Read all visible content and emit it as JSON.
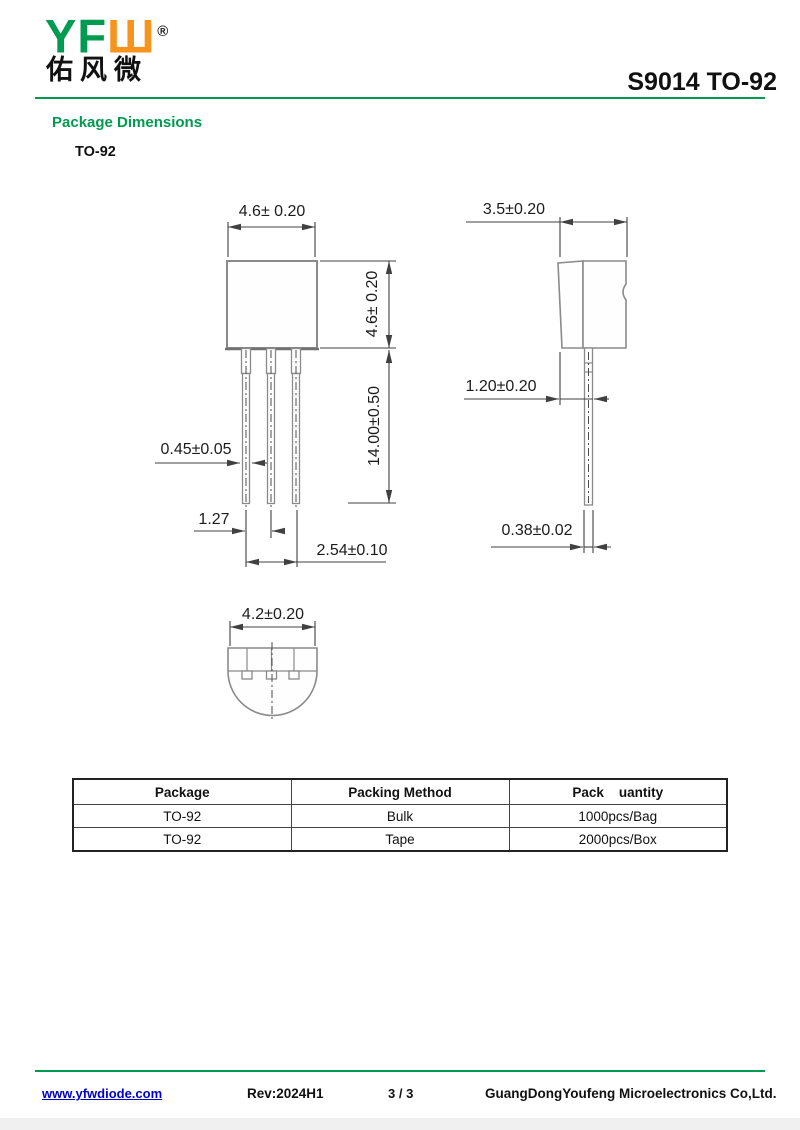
{
  "header": {
    "logo": {
      "text_green": "YF",
      "text_orange": "Ш",
      "registered_mark": "®",
      "chinese_name": "佑风微"
    },
    "title": "S9014 TO-92"
  },
  "section": {
    "heading": "Package Dimensions",
    "subheading": "TO-92"
  },
  "drawing": {
    "front_view": {
      "body_width": "4.6± 0.20",
      "body_height": "4.6± 0.20",
      "lead_length": "14.00±0.50",
      "lead_width": "0.45±0.05",
      "lead_pitch": "1.27",
      "lead_span": "2.54±0.10"
    },
    "side_view": {
      "body_depth": "3.5±0.20",
      "lead_offset": "1.20±0.20",
      "lead_thickness": "0.38±0.02"
    },
    "bottom_view": {
      "body_width": "4.2±0.20"
    }
  },
  "table": {
    "headers": [
      "Package",
      "Packing Method",
      "Pack    uantity"
    ],
    "rows": [
      [
        "TO-92",
        "Bulk",
        "1000pcs/Bag"
      ],
      [
        "TO-92",
        "Tape",
        "2000pcs/Box"
      ]
    ]
  },
  "footer": {
    "website": "www.yfwdiode.com",
    "revision": "Rev:2024H1",
    "page": "3 / 3",
    "company": "GuangDongYoufeng Microelectronics Co,Ltd."
  },
  "colors": {
    "brand_green": "#009a50",
    "brand_orange": "#f7941d",
    "link_blue": "#0000cc"
  }
}
